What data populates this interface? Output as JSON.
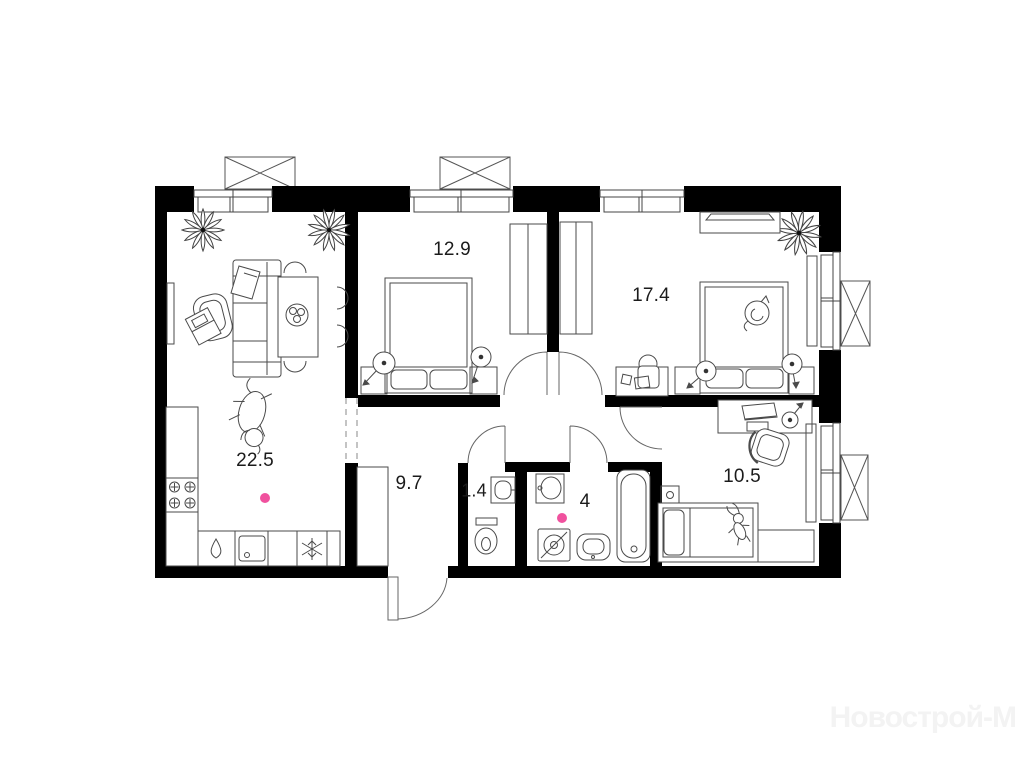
{
  "plan": {
    "watermark": "Новострой-М",
    "rooms": {
      "living_kitchen": {
        "area_label": "22.5"
      },
      "bedroom_small": {
        "area_label": "12.9"
      },
      "bedroom_master": {
        "area_label": "17.4"
      },
      "corridor": {
        "area_label": "9.7"
      },
      "wc": {
        "area_label": "1.4"
      },
      "bathroom": {
        "area_label": "4"
      },
      "kids_room": {
        "area_label": "10.5"
      }
    },
    "icons": {
      "fridge": "snowflake",
      "kettle": "water-drop",
      "stove": "four-burner-hob",
      "washing_machine": "drum-circle-slash",
      "ac_outdoor_unit": "crossed-rectangle",
      "plant": "leaf-rosette"
    },
    "colors": {
      "walls": "#000000",
      "furniture_stroke": "#4a4a4a",
      "marker": "#f0519e",
      "watermark": "#f3f3f3"
    }
  }
}
